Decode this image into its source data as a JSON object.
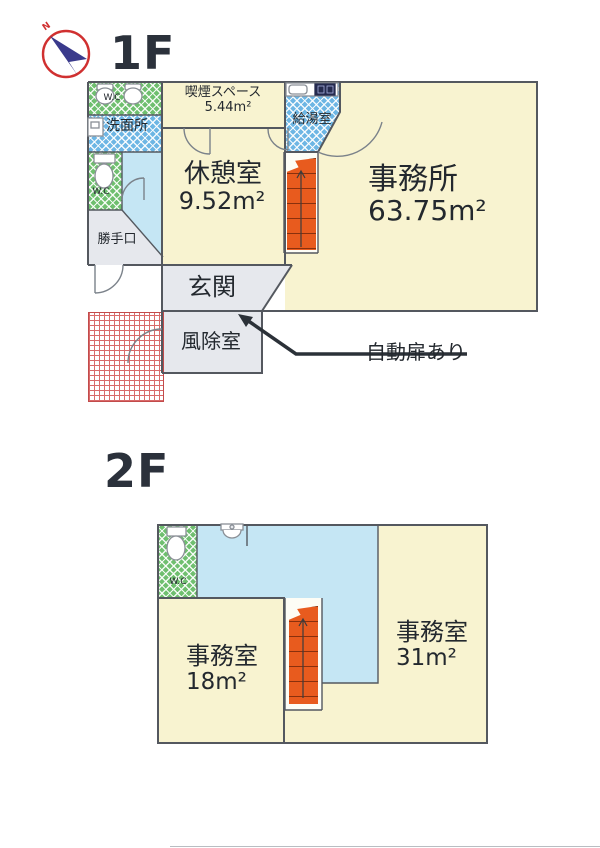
{
  "compass": {
    "label": "N"
  },
  "floors": {
    "f1": {
      "heading": "1F",
      "wc_top": "W.C",
      "washroom": "洗面所",
      "wc_lower": "W.C",
      "back_door": "勝手口",
      "smoking_name": "喫煙スペース",
      "smoking_area": "5.44m²",
      "kitchenette": "給湯室",
      "break_name": "休憩室",
      "break_area": "9.52m²",
      "office_name": "事務所",
      "office_area": "63.75m²",
      "entrance": "玄関",
      "windbreak": "風除室",
      "auto_door_note": "自動扉あり"
    },
    "f2": {
      "heading": "2F",
      "wc": "W.C",
      "office_left_name": "事務室",
      "office_left_area": "18m²",
      "office_right_name": "事務室",
      "office_right_area": "31m²"
    }
  },
  "colors": {
    "room_cream": "#f8f3d0",
    "checker_green": "#6fbf6f",
    "checker_blue": "#6db6e4",
    "light_blue": "#c5e6f4",
    "entry_gray": "#e6e8ed",
    "stair_orange": "#e85b1e",
    "tile_red": "#d96a6a",
    "wall_gray": "#54585f",
    "compass_red": "#d03030",
    "compass_blue": "#3a3a8c"
  }
}
